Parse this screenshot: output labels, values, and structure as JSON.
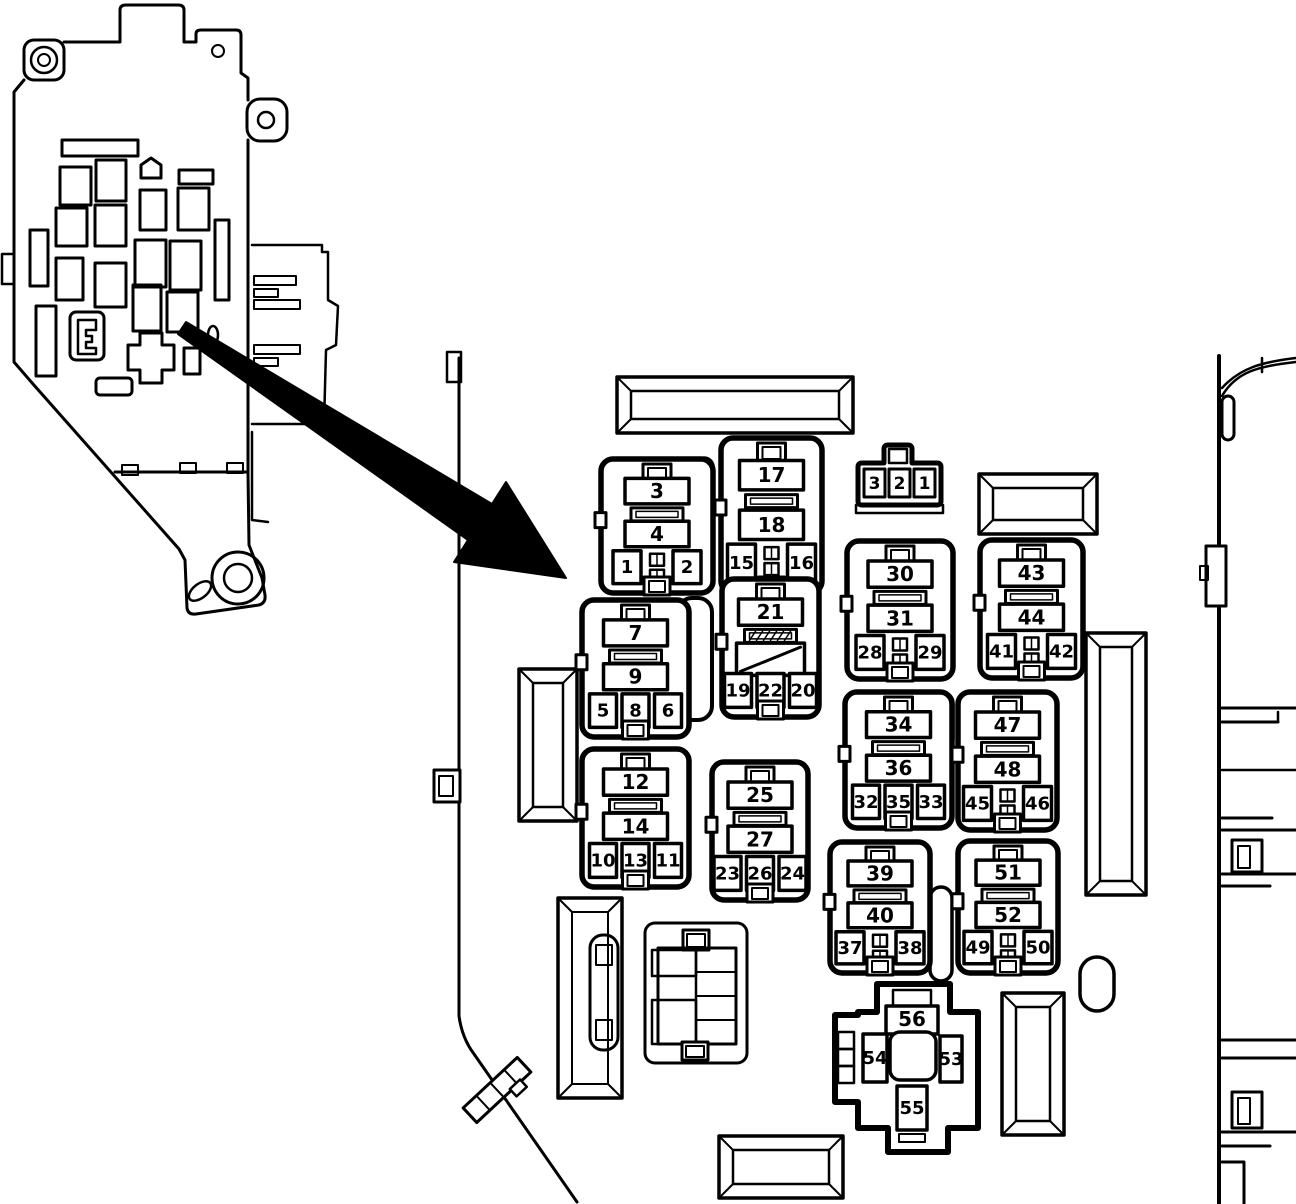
{
  "canvas": {
    "width": 1296,
    "height": 1204
  },
  "colors": {
    "line": "#000000",
    "background": "#ffffff"
  },
  "overview": {
    "description": "junction-block-overview-drawing"
  },
  "connector_321": {
    "x": 858,
    "y": 443,
    "pins": [
      "3",
      "2",
      "1"
    ]
  },
  "relay_blocks": [
    {
      "id": "block-3-4",
      "x": 601,
      "y": 459,
      "w": 112,
      "h": 134,
      "style": "two",
      "top": "3",
      "mid": "4",
      "bottom": [
        "1",
        "2"
      ]
    },
    {
      "id": "block-17-18",
      "x": 721,
      "y": 438,
      "w": 101,
      "h": 155,
      "style": "two",
      "top": "17",
      "mid": "18",
      "bottom": [
        "15",
        "16"
      ]
    },
    {
      "id": "block-30-31",
      "x": 847,
      "y": 541,
      "w": 106,
      "h": 138,
      "style": "two",
      "top": "30",
      "mid": "31",
      "bottom": [
        "28",
        "29"
      ]
    },
    {
      "id": "block-43-44",
      "x": 980,
      "y": 540,
      "w": 103,
      "h": 138,
      "style": "two",
      "top": "43",
      "mid": "44",
      "bottom": [
        "41",
        "42"
      ]
    },
    {
      "id": "block-7-9",
      "x": 582,
      "y": 600,
      "w": 107,
      "h": 137,
      "style": "three",
      "top": "7",
      "mid": "9",
      "bottom": [
        "5",
        "8",
        "6"
      ]
    },
    {
      "id": "block-21",
      "x": 722,
      "y": 579,
      "w": 97,
      "h": 138,
      "style": "diag",
      "top": "21",
      "mid": "",
      "bottom": [
        "19",
        "22",
        "20"
      ]
    },
    {
      "id": "block-12-14",
      "x": 582,
      "y": 749,
      "w": 107,
      "h": 138,
      "style": "three",
      "top": "12",
      "mid": "14",
      "bottom": [
        "10",
        "13",
        "11"
      ]
    },
    {
      "id": "block-25-27",
      "x": 712,
      "y": 762,
      "w": 96,
      "h": 138,
      "style": "three",
      "top": "25",
      "mid": "27",
      "bottom": [
        "23",
        "26",
        "24"
      ]
    },
    {
      "id": "block-34-36",
      "x": 845,
      "y": 692,
      "w": 107,
      "h": 136,
      "style": "three",
      "top": "34",
      "mid": "36",
      "bottom": [
        "32",
        "35",
        "33"
      ]
    },
    {
      "id": "block-47-48",
      "x": 958,
      "y": 692,
      "w": 99,
      "h": 138,
      "style": "two",
      "top": "47",
      "mid": "48",
      "bottom": [
        "45",
        "46"
      ]
    },
    {
      "id": "block-39-40",
      "x": 830,
      "y": 842,
      "w": 100,
      "h": 131,
      "style": "two",
      "top": "39",
      "mid": "40",
      "bottom": [
        "37",
        "38"
      ]
    },
    {
      "id": "block-51-52",
      "x": 958,
      "y": 841,
      "w": 100,
      "h": 132,
      "style": "two",
      "top": "51",
      "mid": "52",
      "bottom": [
        "49",
        "50"
      ]
    }
  ],
  "cross_block": {
    "x": 835,
    "y": 982,
    "labels": {
      "top": "56",
      "left": "54",
      "right": "53",
      "bottom": "55"
    }
  }
}
